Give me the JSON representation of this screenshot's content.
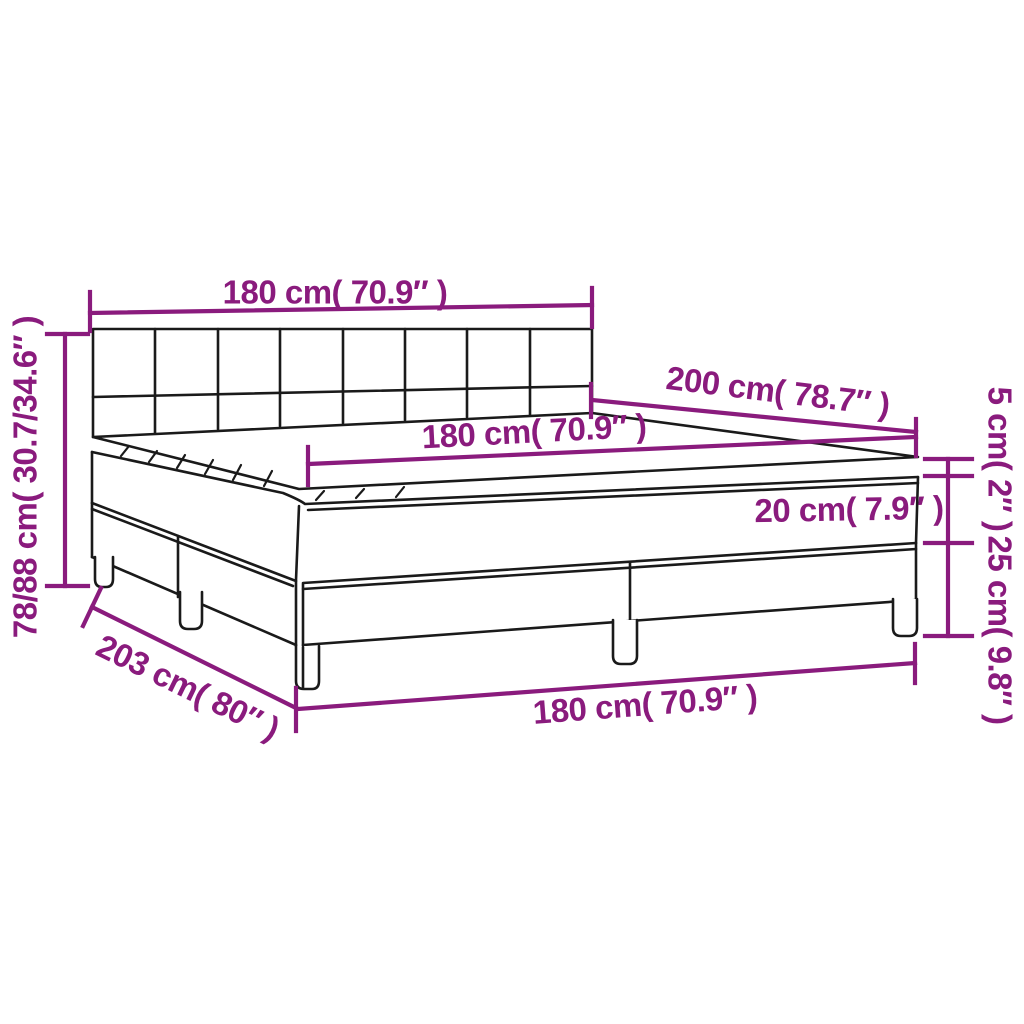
{
  "diagram": {
    "type": "furniture-dimension-diagram",
    "subject": "box spring bed with tufted headboard, two-piece base, mattress and topper",
    "background": "#ffffff",
    "colors": {
      "dimension_accent": "#8A1B7D",
      "outline": "#1A1A1A"
    },
    "labels": {
      "headboard_width": "180 cm( 70.9″ )",
      "total_height": "78/88 cm( 30.7/34.6″ )",
      "mattress_width": "180 cm( 70.9″ )",
      "mattress_length": "200 cm( 78.7″ )",
      "topper_height": "5 cm( 2″ )",
      "mattress_height": "20 cm( 7.9″ )",
      "base_height": "25 cm( 9.8″ )",
      "base_width": "180 cm( 70.9″ )",
      "base_length": "203 cm( 80″ )"
    }
  }
}
